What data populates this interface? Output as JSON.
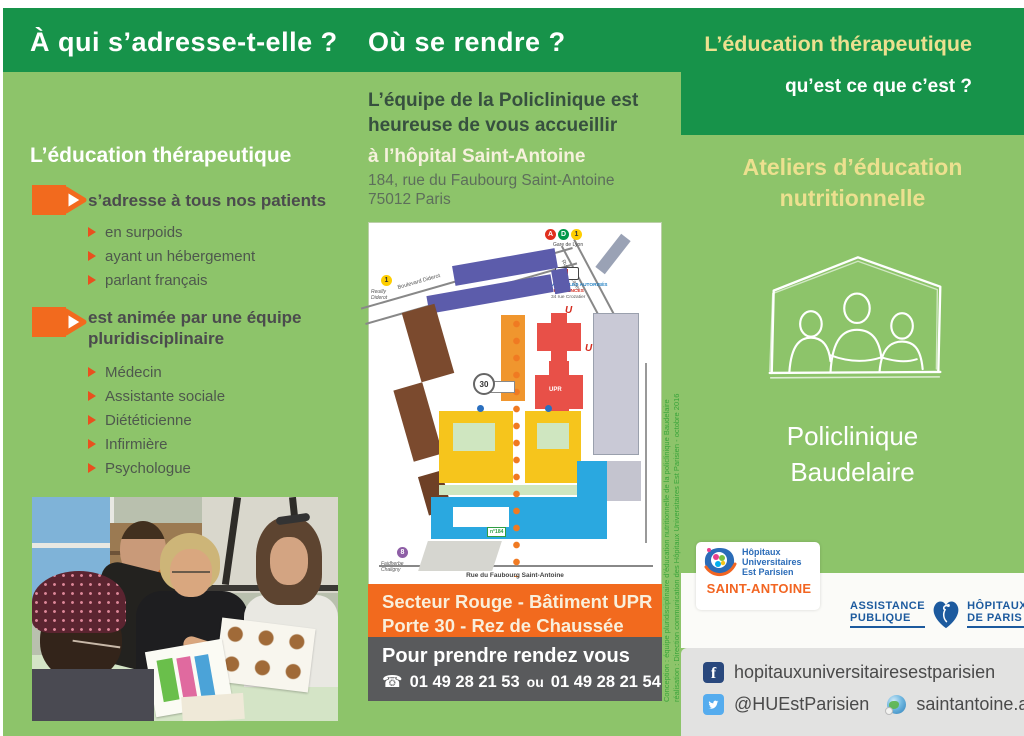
{
  "colors": {
    "dark_green": "#17934a",
    "light_green": "#8dc46a",
    "orange": "#f26a1e",
    "dark_gray_box": "#595a5c",
    "pale_yellow_title": "#ece08f",
    "credits_green": "#3aa43a",
    "facebook_blue": "#29487d",
    "twitter_blue": "#55acee",
    "aphp_blue": "#1c5a9e",
    "saint_antoine_orange": "#f26522"
  },
  "left_panel": {
    "header": "À qui s’adresse-t-elle ?",
    "heading": "L’éducation thérapeutique",
    "bullets": [
      {
        "label": "s’adresse à tous nos patients",
        "items": [
          "en surpoids",
          "ayant un hébergement",
          "parlant français"
        ]
      },
      {
        "label": "est animée par une équipe pluridisciplinaire",
        "items": [
          "Médecin",
          "Assistante sociale",
          "Diététicienne",
          "Infirmière",
          "Psychologue"
        ]
      }
    ]
  },
  "middle_panel": {
    "header": "Où se rendre ?",
    "intro_line1": "L’équipe de la Policlinique est",
    "intro_line2": "heureuse de vous accueillir",
    "hospital": "à l’hôpital Saint-Antoine",
    "address_line1": "184, rue du Faubourg Saint-Antoine",
    "address_line2": "75012 Paris",
    "map": {
      "rer_a": "A",
      "rer_d": "D",
      "metro_1": "1",
      "metro_1b": "1",
      "metro_8": "8",
      "gare_de_lyon": "Gare de Lyon",
      "reuilly_diderot": "Reuilly Diderot",
      "boulevard_diderot": "Boulevard Diderot",
      "rue_crozatier": "Rue Crozatier",
      "vehicules_line1": "VÉHICULES AUTORISÉS",
      "vehicules_line2": "et URGENCES",
      "vehicules_line3": "34 rue Crozatier",
      "urgences_u1": "U",
      "urgences_u2": "U",
      "upr": "UPR",
      "porte": "30",
      "entrance": "n°184",
      "faubourg": "Rue du Faubourg Saint-Antoine",
      "faidherbe_line1": "Faidherbe",
      "faidherbe_line2": "Chaligny"
    },
    "sector_line1": "Secteur Rouge - Bâtiment UPR",
    "sector_line2": "Porte 30 - Rez de Chaussée",
    "appointment_title": "Pour prendre rendez vous",
    "phone_icon": "☎",
    "phone1": "01 49 28 21 53",
    "phone_sep": "ou",
    "phone2": "01 49 28 21 54"
  },
  "right_panel": {
    "title": "L’éducation thérapeutique",
    "subtitle": "qu’est ce que c’est ?",
    "workshop_line1": "Ateliers d’éducation",
    "workshop_line2": "nutritionnelle",
    "clinic_line1": "Policlinique",
    "clinic_line2": "Baudelaire",
    "logo_saint_antoine": {
      "line1": "Hôpitaux",
      "line2": "Universitaires",
      "line3": "Est Parisien",
      "name": "SAINT-ANTOINE"
    },
    "logo_aphp": {
      "left1": "ASSISTANCE",
      "left2": "PUBLIQUE",
      "right1": "HÔPITAUX",
      "right2": "DE PARIS"
    },
    "social": {
      "facebook_icon": "f",
      "facebook": "hopitauxuniversitairesestparisien",
      "twitter": "@HUEstParisien",
      "website": "saintantoine.aphp.fr"
    }
  },
  "credits": {
    "line1": "Conception : équipe pluridisciplinaire d’éducation nutritionnelle de la policlinique Baudelaire",
    "line2": "réalisation : Direction communication des Hôpitaux Universitaires Est Parisien - octobre 2016"
  }
}
